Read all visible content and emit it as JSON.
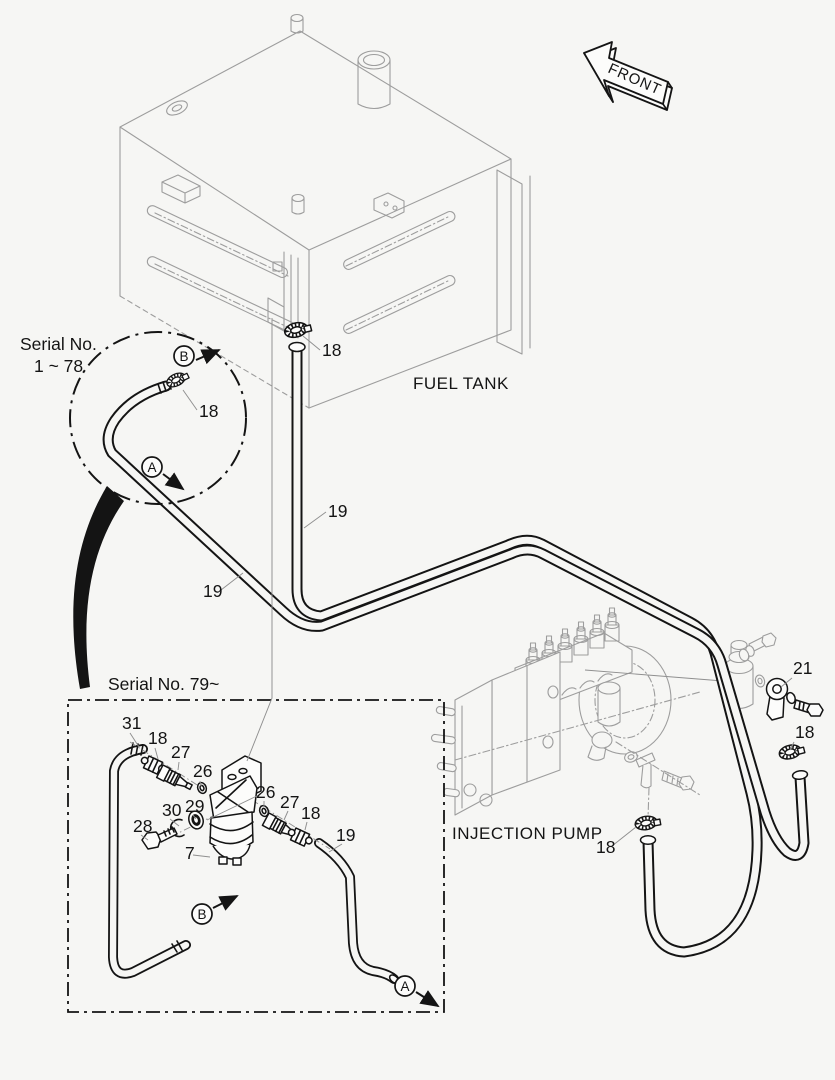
{
  "page": {
    "bg": "#f6f6f4",
    "ink": "#141414",
    "machine": "#9d9d9d",
    "leader": "#8f8f8f"
  },
  "labels": {
    "front": "FRONT",
    "fuel_tank": "FUEL TANK",
    "injection_pump": "INJECTION PUMP",
    "serial_range_early_line1": "Serial No.",
    "serial_range_early_line2": "1 ~ 78",
    "serial_range_late": "Serial No. 79~"
  },
  "callouts": [
    {
      "id": "18-tank-clamp",
      "text": "18",
      "x": 322,
      "y": 356,
      "lx1": 320,
      "ly1": 350,
      "lx2": 303,
      "ly2": 336
    },
    {
      "id": "18-circle-clamp",
      "text": "18",
      "x": 199,
      "y": 417,
      "lx1": 197,
      "ly1": 410,
      "lx2": 183,
      "ly2": 390
    },
    {
      "id": "19-hose-vertical",
      "text": "19",
      "x": 328,
      "y": 517,
      "lx1": 326,
      "ly1": 512,
      "lx2": 304,
      "ly2": 528
    },
    {
      "id": "19-hose-diagonal",
      "text": "19",
      "x": 203,
      "y": 597,
      "lx1": 221,
      "ly1": 590,
      "lx2": 243,
      "ly2": 573
    },
    {
      "id": "21-eye-joint",
      "text": "21",
      "x": 793,
      "y": 674,
      "lx1": 792,
      "ly1": 678,
      "lx2": 781,
      "ly2": 687
    },
    {
      "id": "18-return-clamp",
      "text": "18",
      "x": 795,
      "y": 738,
      "lx1": 794,
      "ly1": 742,
      "lx2": 790,
      "ly2": 750
    },
    {
      "id": "18-pump-clamp",
      "text": "18",
      "x": 596,
      "y": 853,
      "lx1": 612,
      "ly1": 846,
      "lx2": 636,
      "ly2": 827
    },
    {
      "id": "31-hose",
      "text": "31",
      "x": 122,
      "y": 729,
      "lx1": 130,
      "ly1": 733,
      "lx2": 139,
      "ly2": 747
    },
    {
      "id": "18-fitting-left",
      "text": "18",
      "x": 148,
      "y": 744,
      "lx1": 155,
      "ly1": 748,
      "lx2": 158,
      "ly2": 759
    },
    {
      "id": "27-nipple-left",
      "text": "27",
      "x": 171,
      "y": 758,
      "lx1": 179,
      "ly1": 762,
      "lx2": 178,
      "ly2": 770
    },
    {
      "id": "26-oring-left",
      "text": "26",
      "x": 193,
      "y": 777,
      "lx1": 200,
      "ly1": 781,
      "lx2": 201,
      "ly2": 786
    },
    {
      "id": "29-seal",
      "text": "29",
      "x": 185,
      "y": 812,
      "lx1": 193,
      "ly1": 815,
      "lx2": 196,
      "ly2": 819
    },
    {
      "id": "30-clip",
      "text": "30",
      "x": 162,
      "y": 816,
      "lx1": 170,
      "ly1": 819,
      "lx2": 179,
      "ly2": 826
    },
    {
      "id": "28-bolt",
      "text": "28",
      "x": 133,
      "y": 832,
      "lx1": 141,
      "ly1": 835,
      "lx2": 148,
      "ly2": 840
    },
    {
      "id": "26-oring-right",
      "text": "26",
      "x": 256,
      "y": 798,
      "lx1": 264,
      "ly1": 801,
      "lx2": 264,
      "ly2": 807
    },
    {
      "id": "27-nipple-right",
      "text": "27",
      "x": 280,
      "y": 808,
      "lx1": 288,
      "ly1": 811,
      "lx2": 284,
      "ly2": 820
    },
    {
      "id": "18-fitting-right",
      "text": "18",
      "x": 301,
      "y": 819,
      "lx1": 307,
      "ly1": 822,
      "lx2": 305,
      "ly2": 830
    },
    {
      "id": "19-hose-box",
      "text": "19",
      "x": 336,
      "y": 841,
      "lx1": 342,
      "ly1": 844,
      "lx2": 329,
      "ly2": 852
    },
    {
      "id": "7-water-separator",
      "text": "7",
      "x": 185,
      "y": 859,
      "lx1": 193,
      "ly1": 855,
      "lx2": 210,
      "ly2": 857
    }
  ],
  "direction_markers": [
    {
      "id": "circle-b",
      "letter": "B",
      "cx": 184,
      "cy": 356,
      "ax1": 196,
      "ay1": 360,
      "ax2": 219,
      "ay2": 350
    },
    {
      "id": "circle-a",
      "letter": "A",
      "cx": 152,
      "cy": 467,
      "ax1": 163,
      "ay1": 474,
      "ax2": 183,
      "ay2": 489
    },
    {
      "id": "box-b",
      "letter": "B",
      "cx": 202,
      "cy": 914,
      "ax1": 213,
      "ay1": 908,
      "ax2": 237,
      "ay2": 896
    },
    {
      "id": "box-a",
      "letter": "A",
      "cx": 405,
      "cy": 986,
      "ax1": 416,
      "ay1": 992,
      "ax2": 438,
      "ay2": 1006
    }
  ]
}
